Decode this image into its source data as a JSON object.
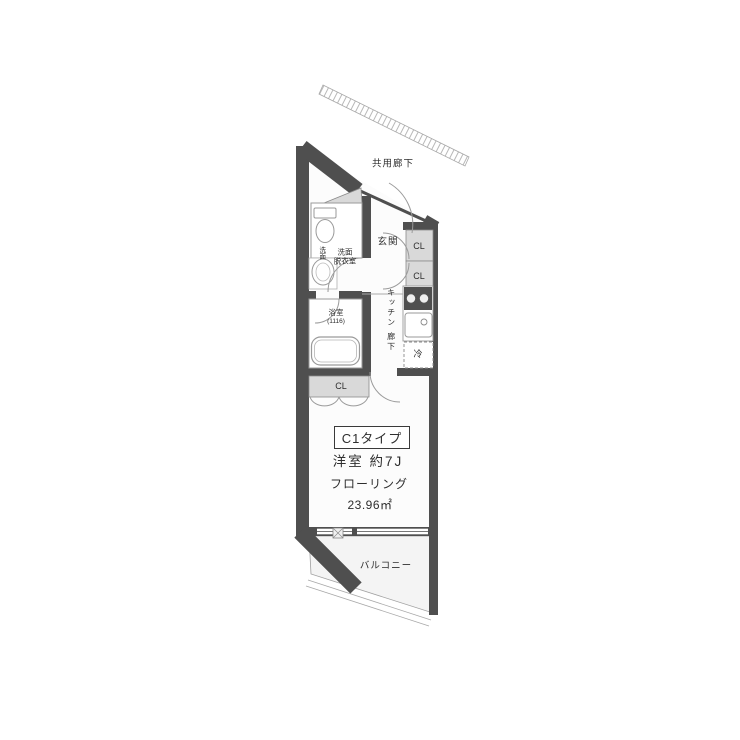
{
  "plan": {
    "unit_type": "C1タイプ",
    "room_info": {
      "title": "洋室 約7J",
      "flooring": "フローリング",
      "area": "23.96㎡"
    },
    "labels": {
      "common_corridor": "共用廊下",
      "entrance": "玄関",
      "closet_upper": "CL",
      "closet_lower": "CL",
      "closet_room": "CL",
      "washroom_line1": "洗面",
      "washroom_line2": "脱衣室",
      "basin": "洗面",
      "bath": "浴室",
      "bath_size": "(1116)",
      "kitchen": "キッチン",
      "hallway": "廊下",
      "refrigerator": "冷",
      "balcony": "バルコニー"
    },
    "colors": {
      "wall": "#4f4f4f",
      "light_fill": "#d9d9d9",
      "floor": "#fcfcfc",
      "balcony": "#f4f4f4",
      "line": "#9a9a9a",
      "text": "#2e2e2e"
    }
  }
}
